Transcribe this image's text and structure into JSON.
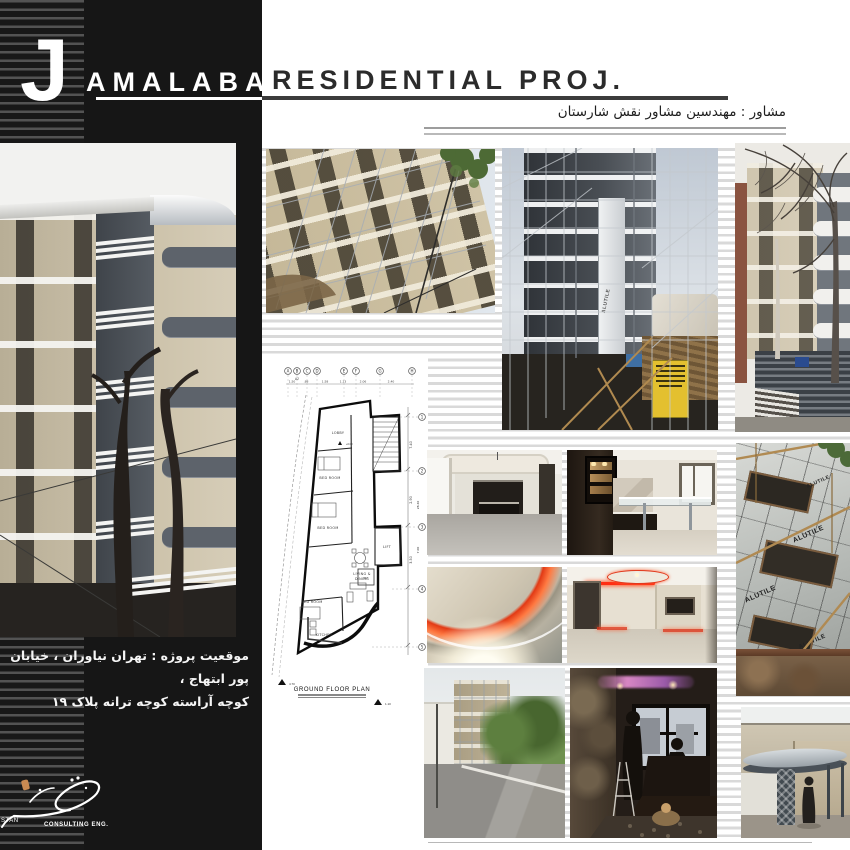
{
  "title": {
    "initial": "J",
    "name": "AMALABAD",
    "type": "RESIDENTIAL PROJ."
  },
  "consultant_fa": "مشاور : مهندسین مشاور نقش شارستان",
  "address_fa": {
    "line1": "موقعیت پروژه : تهران نیاوران ، خیابان پور ابتهاج ،",
    "line2": "کوچه آراسته  کوچه ترانه پلاک ۱۹"
  },
  "logo": {
    "stan": "STAN",
    "consulting": "CONSULTING ENG."
  },
  "plan": {
    "grid_letters": [
      "A",
      "B",
      "C",
      "D",
      "E",
      "F",
      "G",
      "H"
    ],
    "grid_numbers": [
      "1",
      "2",
      "3",
      "4",
      "5"
    ],
    "top_dims": [
      "1.50",
      ".88",
      "1.58",
      "1.13",
      "2.06",
      "2.40"
    ],
    "ref": "A2",
    "right_dims": [
      "7.40",
      "2.90",
      "3.50",
      "28.40",
      "7.00"
    ],
    "marks": {
      "zero": "+0.00",
      "left": "4.70",
      "right": "1.10"
    },
    "rooms": {
      "lobby": "LOBBY",
      "bed": "BED ROOM",
      "living": "LIVING &",
      "dining": "DINING",
      "kitchen": "KITCHEN",
      "lift": "LIFT",
      "wc": "WC"
    },
    "caption": "GROUND FLOOR PLAN"
  },
  "photo_text": {
    "alutile": "ALUTILE"
  },
  "colors": {
    "black_column": "#161616",
    "stripe_dark": "#535353",
    "stripe_light": "#d9d9d9",
    "accent_red": "#e03518",
    "panel_gray": "#4a4f55",
    "yellow_sign": "#e0bc2e"
  }
}
